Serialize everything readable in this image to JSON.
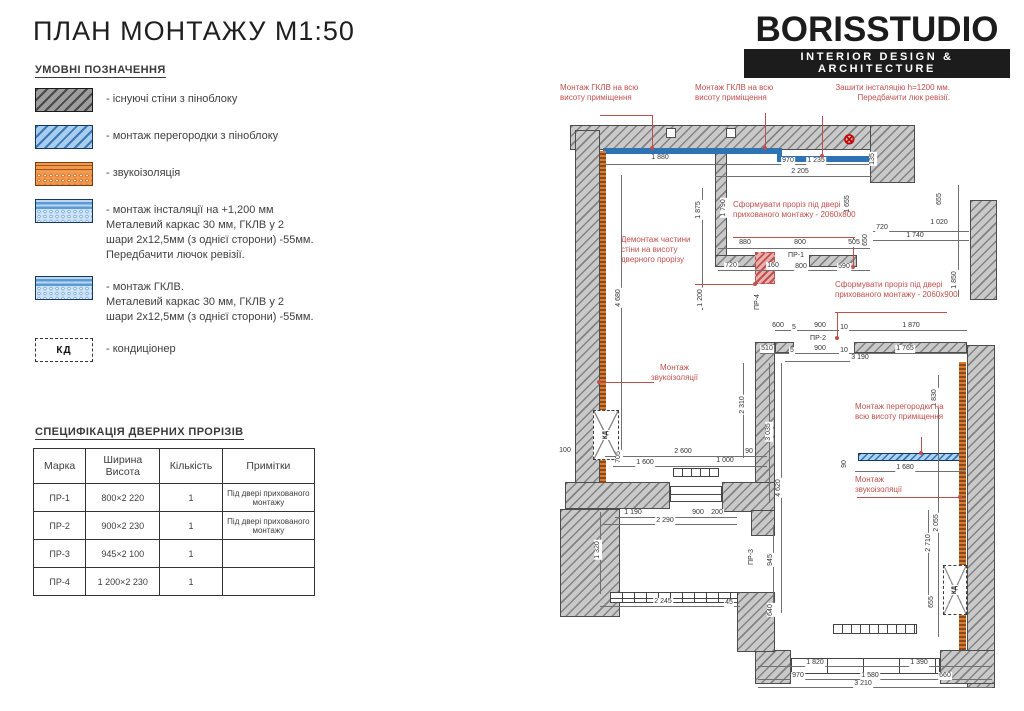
{
  "sheet": {
    "title": "ПЛАН МОНТАЖУ М1:50"
  },
  "logo": {
    "name": "BORISSTUDIO",
    "tagline": "INTERIOR DESIGN & ARCHITECTURE"
  },
  "legend": {
    "heading": "УМОВНІ ПОЗНАЧЕННЯ",
    "items": [
      {
        "swatch": "existing",
        "lines": [
          "- існуючі стіни з піноблоку"
        ]
      },
      {
        "swatch": "partition",
        "lines": [
          "- монтаж перегородки з піноблоку"
        ]
      },
      {
        "swatch": "sound",
        "lines": [
          "- звукоізоляція"
        ]
      },
      {
        "swatch": "inst",
        "lines": [
          "- монтаж інсталяції на +1,200 мм",
          "Металевий каркас 30 мм, ГКЛВ у 2",
          "шари 2х12,5мм (з однієї сторони) -55мм.",
          "Передбачити лючок ревізії."
        ]
      },
      {
        "swatch": "gklv",
        "lines": [
          "- монтаж ГКЛВ.",
          "Металевий каркас 30 мм, ГКЛВ у 2",
          "шари 2х12,5мм (з однієї сторони) -55мм."
        ]
      },
      {
        "swatch": "cond",
        "swatch_text": "КД",
        "lines": [
          "- кондиціонер"
        ]
      }
    ]
  },
  "spec": {
    "heading": "СПЕЦИФІКАЦІЯ ДВЕРНИХ ПРОРІЗІВ",
    "columns": [
      "Марка",
      "Ширина Висота",
      "Кількість",
      "Примітки"
    ],
    "rows": [
      [
        "ПР-1",
        "800×2 220",
        "1",
        "Під двері прихованого монтажу"
      ],
      [
        "ПР-2",
        "900×2 230",
        "1",
        "Під двері прихованого монтажу"
      ],
      [
        "ПР-3",
        "945×2 100",
        "1",
        ""
      ],
      [
        "ПР-4",
        "1 200×2 230",
        "1",
        ""
      ]
    ]
  },
  "plan": {
    "annotations": [
      {
        "t": "Монтаж ГКЛВ на всю висоту приміщення",
        "x": 5,
        "y": 3,
        "w": 100,
        "a": "left"
      },
      {
        "t": "Монтаж ГКЛВ на всю висоту приміщення",
        "x": 140,
        "y": 3,
        "w": 100,
        "a": "left"
      },
      {
        "t": "Зашити інсталяцію h=1200 мм. Передбачити люк ревізії.",
        "x": 255,
        "y": 3,
        "w": 140,
        "a": "right"
      },
      {
        "t": "Демонтаж частини стіни на висоту дверного прорізу",
        "x": 66,
        "y": 155,
        "w": 90,
        "a": "left"
      },
      {
        "t": "Сформувати проріз під двері прихованого монтажу - 2060х800",
        "x": 178,
        "y": 120,
        "w": 128,
        "a": "left"
      },
      {
        "t": "Сформувати проріз під двері прихованого монтажу - 2060х900",
        "x": 280,
        "y": 200,
        "w": 128,
        "a": "left"
      },
      {
        "t": "Монтаж звукоізоляції",
        "x": 82,
        "y": 283,
        "w": 75,
        "a": "center"
      },
      {
        "t": "Монтаж перегородки на всю висоту приміщення",
        "x": 300,
        "y": 322,
        "w": 92,
        "a": "left"
      },
      {
        "t": "Монтаж звукоізоляції",
        "x": 300,
        "y": 395,
        "w": 75,
        "a": "left"
      }
    ],
    "h_labels": [
      [
        "1 880",
        105,
        78
      ],
      [
        "970",
        233,
        81
      ],
      [
        "1 235",
        261,
        81
      ],
      [
        "2 205",
        245,
        92
      ],
      [
        "880",
        190,
        163
      ],
      [
        "800",
        245,
        163
      ],
      [
        "505",
        299,
        163
      ],
      [
        "720",
        176,
        186
      ],
      [
        "160",
        218,
        186
      ],
      [
        "800",
        246,
        187
      ],
      [
        "590",
        289,
        187
      ],
      [
        "ПР-1",
        241,
        176
      ],
      [
        "720",
        327,
        148
      ],
      [
        "1 020",
        384,
        143
      ],
      [
        "1 740",
        360,
        156
      ],
      [
        "600",
        223,
        246
      ],
      [
        "5",
        239,
        248
      ],
      [
        "900",
        265,
        246
      ],
      [
        "10",
        289,
        248
      ],
      [
        "1 870",
        356,
        246
      ],
      [
        "ПР-2",
        263,
        259
      ],
      [
        "510",
        212,
        269
      ],
      [
        "5",
        237,
        271
      ],
      [
        "900",
        265,
        269
      ],
      [
        "10",
        289,
        271
      ],
      [
        "1 765",
        350,
        269
      ],
      [
        "3 190",
        305,
        278
      ],
      [
        "1 680",
        350,
        388
      ],
      [
        "2 600",
        128,
        372
      ],
      [
        "90",
        194,
        372
      ],
      [
        "1 600",
        90,
        383
      ],
      [
        "1 000",
        170,
        381
      ],
      [
        "100",
        10,
        371
      ],
      [
        "1 190",
        78,
        433
      ],
      [
        "900",
        143,
        433
      ],
      [
        "200",
        162,
        433
      ],
      [
        "2 290",
        110,
        441
      ],
      [
        "2 245",
        108,
        522
      ],
      [
        "45",
        174,
        523
      ],
      [
        "1 820",
        260,
        583
      ],
      [
        "1 390",
        364,
        583
      ],
      [
        "970",
        243,
        596
      ],
      [
        "1 580",
        315,
        596
      ],
      [
        "660",
        390,
        596
      ],
      [
        "3 210",
        308,
        604
      ]
    ],
    "v_labels": [
      [
        "1 875",
        144,
        130
      ],
      [
        "1 790",
        169,
        128
      ],
      [
        "1 655",
        293,
        124
      ],
      [
        "650",
        311,
        160
      ],
      [
        "135",
        318,
        79
      ],
      [
        "655",
        385,
        119
      ],
      [
        "1 850",
        400,
        200
      ],
      [
        "4 680",
        64,
        218
      ],
      [
        "1 200",
        146,
        218
      ],
      [
        "2 310",
        188,
        325
      ],
      [
        "3 035",
        214,
        352
      ],
      [
        "4 620",
        224,
        408
      ],
      [
        "705",
        64,
        377
      ],
      [
        "1 320",
        43,
        470
      ],
      [
        "945",
        216,
        480
      ],
      [
        "640",
        216,
        530
      ],
      [
        "ПР-3",
        197,
        477
      ],
      [
        "ПР-4",
        203,
        222
      ],
      [
        "1 830",
        380,
        318
      ],
      [
        "90",
        290,
        384
      ],
      [
        "2 055",
        382,
        443
      ],
      [
        "2 710",
        374,
        463
      ],
      [
        "655",
        377,
        522
      ]
    ]
  },
  "colors": {
    "annotation_red": "#c0504d",
    "gkl_blue": "#2e74b5",
    "partition_blue": "#aed2f0",
    "insulation_orange": "#d97b2e",
    "wall_gray": "#c9c9c9"
  }
}
